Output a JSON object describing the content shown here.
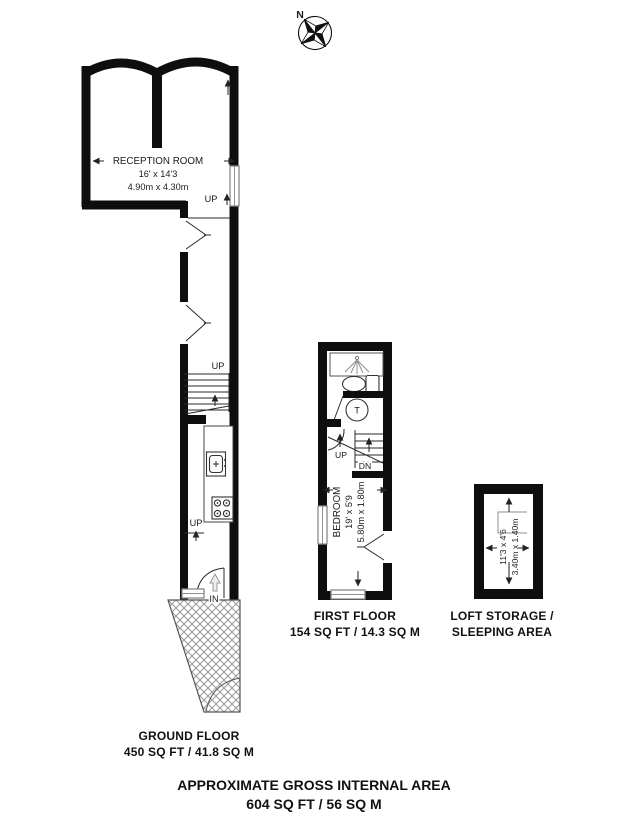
{
  "compass": {
    "north_label": "N"
  },
  "ground_floor": {
    "reception_room": {
      "name": "RECEPTION ROOM",
      "size_imperial": "16' x 14'3",
      "size_metric": "4.90m x 4.30m"
    },
    "stairs_label_reception": "UP",
    "stairs_label_mid": "UP",
    "stairs_label_entry": "UP",
    "entry_label": "IN",
    "caption": {
      "line1": "GROUND FLOOR",
      "line2": "450 SQ FT / 41.8 SQ M"
    }
  },
  "first_floor": {
    "bedroom": {
      "name": "BEDROOM",
      "size_imperial": "19' x 5'9",
      "size_metric": "5.80m x 1.80m"
    },
    "stairs_up_label": "UP",
    "stairs_down_label": "DN",
    "tank_label": "T",
    "caption": {
      "line1": "FIRST FLOOR",
      "line2": "154 SQ FT / 14.3 SQ M"
    }
  },
  "loft": {
    "size_imperial": "11'3 x 4'6",
    "size_metric": "3.40m x 1.40m",
    "caption": {
      "line1": "LOFT STORAGE /",
      "line2": "SLEEPING AREA"
    }
  },
  "footer": {
    "line1": "APPROXIMATE GROSS INTERNAL AREA",
    "line2": "604 SQ FT / 56 SQ M"
  },
  "colors": {
    "wall": "#0e0e0e",
    "window_frame": "#8a8a8a",
    "hatch_line": "#999999",
    "text": "#1c1c1c"
  }
}
